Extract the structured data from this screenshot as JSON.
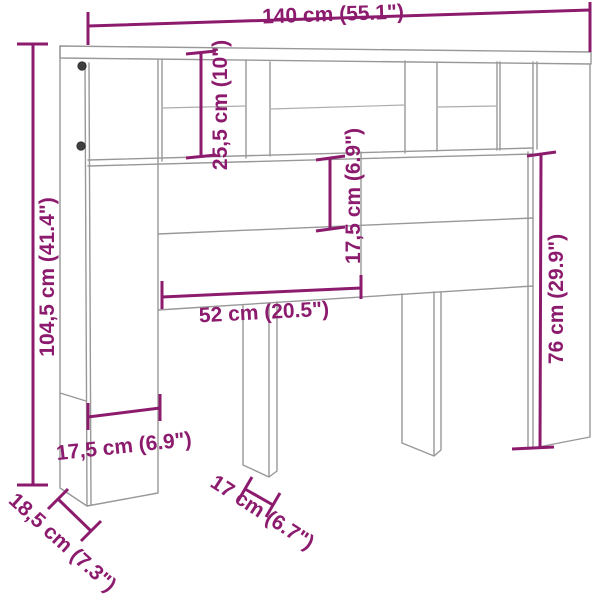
{
  "diagram": {
    "subject": "headboard-cabinet-dimension-drawing",
    "dimensions": {
      "width_top": "140 cm (55.1\")",
      "height_left": "104,5 cm (41.4\")",
      "shelf_height": "25,5 cm (10\")",
      "panel_height": "17,5 cm (6.9\")",
      "opening_width": "52 cm (20.5\")",
      "side_height": "76 cm (29.9\")",
      "column_width": "17,5 cm (6.9\")",
      "depth": "18,5 cm (7.3\")",
      "leg_depth": "17 cm (6.7\")"
    },
    "colors": {
      "dimension": "#8c1b6e",
      "outline": "#989898",
      "background": "#ffffff"
    }
  }
}
